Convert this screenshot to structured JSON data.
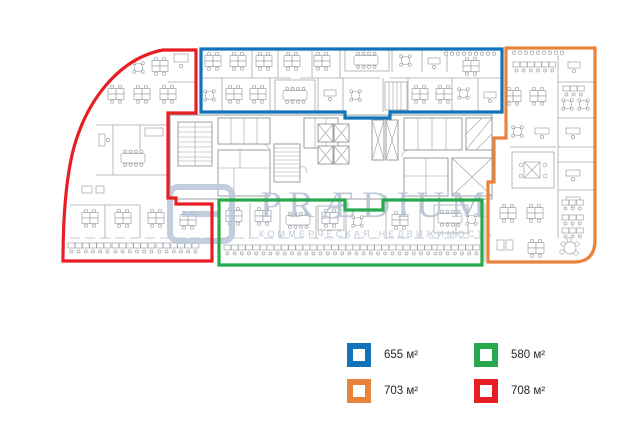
{
  "watermark": {
    "brand": "PRÆDIUM",
    "tagline": "КОММЕРЧЕСКАЯ НЕДВИЖИМОСТЬ",
    "color": "#b7c5d7"
  },
  "zones": [
    {
      "id": "blue",
      "color": "#1273b9",
      "area": "655 м²"
    },
    {
      "id": "green",
      "color": "#27a94d",
      "area": "580 м²"
    },
    {
      "id": "orange",
      "color": "#e8823c",
      "area": "703 м²"
    },
    {
      "id": "red",
      "color": "#e81e25",
      "area": "708 м²"
    }
  ],
  "legend": {
    "items": [
      {
        "zone": "blue",
        "label": "655 м²"
      },
      {
        "zone": "green",
        "label": "580 м²"
      },
      {
        "zone": "orange",
        "label": "703 м²"
      },
      {
        "zone": "red",
        "label": "708 м²"
      }
    ]
  }
}
